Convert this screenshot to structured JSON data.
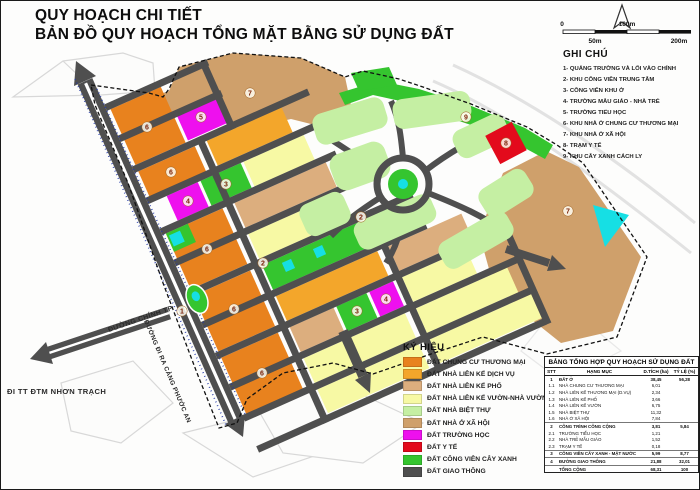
{
  "title": {
    "line1": "QUY HOẠCH CHI TIẾT",
    "line2": "BẢN ĐỒ QUY HOẠCH TỔNG MẶT BẰNG SỬ DỤNG ĐẤT"
  },
  "scale_bar": {
    "labels": [
      {
        "t": "0",
        "x": 561,
        "y": 25,
        "anchor": "middle"
      },
      {
        "t": "100m",
        "x": 626,
        "y": 25,
        "anchor": "middle"
      },
      {
        "t": "50m",
        "x": 594,
        "y": 42,
        "anchor": "middle"
      },
      {
        "t": "200m",
        "x": 678,
        "y": 42,
        "anchor": "middle"
      }
    ]
  },
  "ghi_chu": {
    "heading": "GHI CHÚ",
    "items": [
      "1- QUẢNG TRƯỜNG VÀ LỐI VÀO CHÍNH",
      "2- KHU CÔNG VIÊN TRUNG TÂM",
      "3- CÔNG VIÊN KHU Ở",
      "4- TRƯỜNG MẪU GIÁO - NHÀ TRẺ",
      "5- TRƯỜNG TIỂU HỌC",
      "6- KHU NHÀ Ở CHUNG CƯ THƯƠNG MẠI",
      "7- KHU NHÀ Ở XÃ HỘI",
      "8- TRẠM Y TẾ",
      "9- KHU CÂY XANH CÁCH LY"
    ]
  },
  "ky_hieu": {
    "heading": "KÝ HIỆU",
    "items": [
      {
        "key": "orange",
        "label": "ĐẤT CHUNG CƯ THƯƠNG MẠI"
      },
      {
        "key": "amber",
        "label": "ĐẤT NHÀ LIÊN KẾ DỊCH VỤ"
      },
      {
        "key": "tan",
        "label": "ĐẤT NHÀ LIÊN KẾ PHỐ"
      },
      {
        "key": "paleyellow",
        "label": "ĐẤT NHÀ LIÊN KẾ VƯỜN-NHÀ VƯỜN"
      },
      {
        "key": "palegreen",
        "label": "ĐẤT NHÀ BIỆT THỰ"
      },
      {
        "key": "tandark",
        "label": "ĐẤT NHÀ Ở XÃ HỘI"
      },
      {
        "key": "magenta",
        "label": "ĐẤT TRƯỜNG HỌC"
      },
      {
        "key": "red",
        "label": "ĐẤT Y TẾ"
      },
      {
        "key": "green",
        "label": "ĐẤT CÔNG VIÊN CÂY XANH"
      },
      {
        "key": "road",
        "label": "ĐẤT GIAO THÔNG"
      }
    ]
  },
  "table": {
    "title": "BẢNG TỔNG HỢP QUY HOẠCH SỬ DỤNG ĐẤT",
    "columns": [
      "STT",
      "HẠNG MỤC",
      "D.TÍCH (ha)",
      "TỶ LỆ (%)"
    ],
    "rows": [
      {
        "stt": "1",
        "name": "ĐẤT Ở",
        "area": "38,45",
        "pct": "56,28",
        "b": 1
      },
      {
        "stt": "1.1",
        "name": "NHÀ CHUNG CƯ THƯƠNG MẠI",
        "area": "6,01",
        "pct": "",
        "b": 0
      },
      {
        "stt": "1.2",
        "name": "NHÀ LIÊN KẾ THƯƠNG MẠI (D.VỤ)",
        "area": "2,34",
        "pct": "",
        "b": 0
      },
      {
        "stt": "1.3",
        "name": "NHÀ LIÊN KẾ PHỐ",
        "area": "3,66",
        "pct": "",
        "b": 0
      },
      {
        "stt": "1.4",
        "name": "NHÀ LIÊN KẾ VƯỜN",
        "area": "6,75",
        "pct": "",
        "b": 0
      },
      {
        "stt": "1.5",
        "name": "NHÀ BIỆT THỰ",
        "area": "11,32",
        "pct": "",
        "b": 0
      },
      {
        "stt": "1.6",
        "name": "NHÀ Ở XÃ HỘI",
        "area": "7,84",
        "pct": "",
        "b": 0
      },
      {
        "stt": "2",
        "name": "CÔNG TRÌNH CÔNG CỘNG",
        "area": "3,81",
        "pct": "5,84",
        "b": 1
      },
      {
        "stt": "2.1",
        "name": "TRƯỜNG TIỂU HỌC",
        "area": "1,21",
        "pct": "",
        "b": 0
      },
      {
        "stt": "2.2",
        "name": "NHÀ TRẺ MẪU GIÁO",
        "area": "1,52",
        "pct": "",
        "b": 0
      },
      {
        "stt": "2.3",
        "name": "TRẠM Y TẾ",
        "area": "0,18",
        "pct": "",
        "b": 0
      },
      {
        "stt": "3",
        "name": "CÔNG VIÊN CÂY XANH - MẶT NƯỚC",
        "area": "5,99",
        "pct": "8,77",
        "b": 1
      },
      {
        "stt": "4",
        "name": "ĐƯỜNG GIAO THÔNG",
        "area": "21,88",
        "pct": "32,01",
        "b": 1
      },
      {
        "stt": "",
        "name": "TỔNG CỘNG",
        "area": "68,31",
        "pct": "100",
        "b": 1
      }
    ]
  },
  "map": {
    "palette": {
      "orange": "#E8821E",
      "amber": "#F3A62B",
      "tan": "#DCAE7E",
      "paleyellow": "#F7F9A4",
      "palegreen": "#C5EFA3",
      "tandark": "#CFA06B",
      "magenta": "#EE10EE",
      "red": "#E30A1C",
      "green": "#35C52F",
      "road": "#4F4F4F",
      "cyan": "#16DFE4"
    },
    "road_labels": [
      {
        "text": "ĐƯỜNG CHÍNH TP",
        "x": 108,
        "y": 331,
        "rot": -19,
        "size": 7
      },
      {
        "text": "ĐƯỜNG ĐI RA CẢNG PHƯỚC AN",
        "x": 143,
        "y": 320,
        "rot": 67,
        "size": 6.4
      },
      {
        "text": "ĐI TT ĐTM NHƠN TRẠCH",
        "x": 6,
        "y": 393,
        "rot": 0,
        "size": 7.6
      }
    ],
    "block_numbers": [
      {
        "n": "6",
        "x": 146,
        "y": 126
      },
      {
        "n": "5",
        "x": 200,
        "y": 116
      },
      {
        "n": "7",
        "x": 249,
        "y": 92
      },
      {
        "n": "6",
        "x": 170,
        "y": 171
      },
      {
        "n": "4",
        "x": 187,
        "y": 200
      },
      {
        "n": "3",
        "x": 225,
        "y": 183
      },
      {
        "n": "6",
        "x": 206,
        "y": 248
      },
      {
        "n": "2",
        "x": 262,
        "y": 262
      },
      {
        "n": "2",
        "x": 360,
        "y": 216
      },
      {
        "n": "6",
        "x": 233,
        "y": 308
      },
      {
        "n": "1",
        "x": 181,
        "y": 310
      },
      {
        "n": "3",
        "x": 356,
        "y": 310
      },
      {
        "n": "4",
        "x": 385,
        "y": 298
      },
      {
        "n": "6",
        "x": 261,
        "y": 372
      },
      {
        "n": "9",
        "x": 465,
        "y": 116
      },
      {
        "n": "8",
        "x": 505,
        "y": 142
      },
      {
        "n": "7",
        "x": 567,
        "y": 210
      }
    ]
  }
}
